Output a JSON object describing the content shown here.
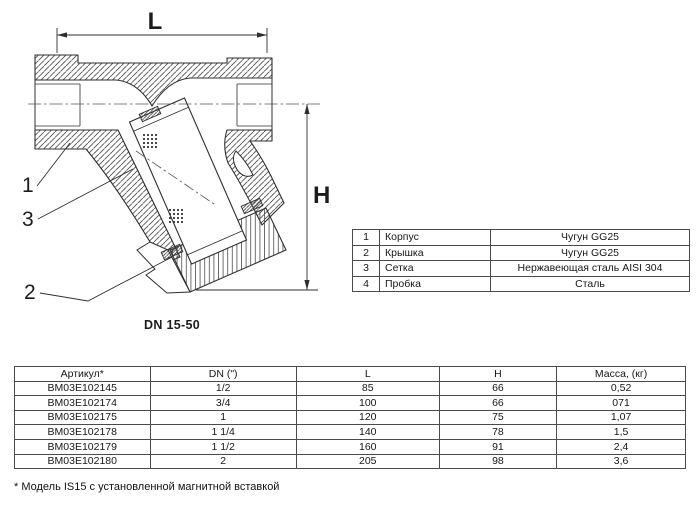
{
  "drawing": {
    "dim_length_label": "L",
    "dim_height_label": "H",
    "part_label_1": "1",
    "part_label_2": "2",
    "part_label_3": "3",
    "caption": "DN 15-50"
  },
  "materials_table": {
    "rows": [
      {
        "num": "1",
        "name": "Корпус",
        "material": "Чугун GG25"
      },
      {
        "num": "2",
        "name": "Крышка",
        "material": "Чугун GG25"
      },
      {
        "num": "3",
        "name": "Сетка",
        "material": "Нержавеющая сталь AISI 304"
      },
      {
        "num": "4",
        "name": "Пробка",
        "material": "Сталь"
      }
    ]
  },
  "dimensions_table": {
    "headers": [
      "Артикул*",
      "DN (\")",
      "L",
      "H",
      "Масса, (кг)"
    ],
    "rows": [
      [
        "BM03E102145",
        "1/2",
        "85",
        "66",
        "0,52"
      ],
      [
        "BM03E102174",
        "3/4",
        "100",
        "66",
        "071"
      ],
      [
        "BM03E102175",
        "1",
        "120",
        "75",
        "1,07"
      ],
      [
        "BM03E102178",
        "1 1/4",
        "140",
        "78",
        "1,5"
      ],
      [
        "BM03E102179",
        "1 1/2",
        "160",
        "91",
        "2,4"
      ],
      [
        "BM03E102180",
        "2",
        "205",
        "98",
        "3,6"
      ]
    ]
  },
  "footnote": "* Модель IS15 с установленной магнитной вставкой",
  "colors": {
    "line": "#2f2f2f",
    "table_border": "#4a4a4a",
    "text": "#161616",
    "background": "#ffffff"
  }
}
